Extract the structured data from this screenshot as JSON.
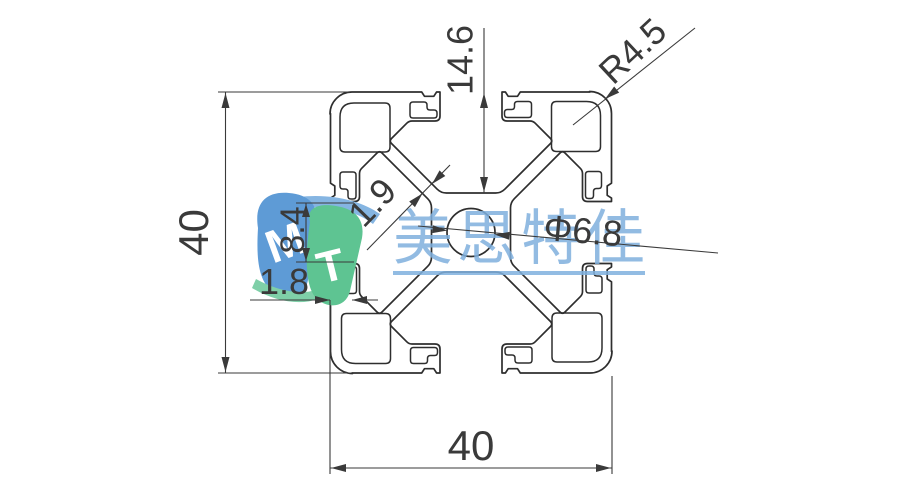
{
  "drawing": {
    "dimensions": {
      "overall_height": "40",
      "overall_width": "40",
      "slot_depth": "14.6",
      "corner_radius": "R4.5",
      "center_hole_dia": "Φ6.8",
      "web_thickness": "1.9",
      "slot_opening": "8.4",
      "wall_thickness": "1.8"
    },
    "watermark": {
      "text": "美思特佳",
      "logo_letter_m": "M",
      "logo_letter_t": "T"
    },
    "colors": {
      "background": "#ffffff",
      "profile_line": "#2e2e2e",
      "dimension": "#3a3a3a",
      "watermark_text": "#7fb0de",
      "logo_blue": "#5e9bd6",
      "logo_blue_light": "#85b5e2",
      "logo_green": "#5ec492",
      "logo_green_light": "#7fcfa8"
    }
  }
}
